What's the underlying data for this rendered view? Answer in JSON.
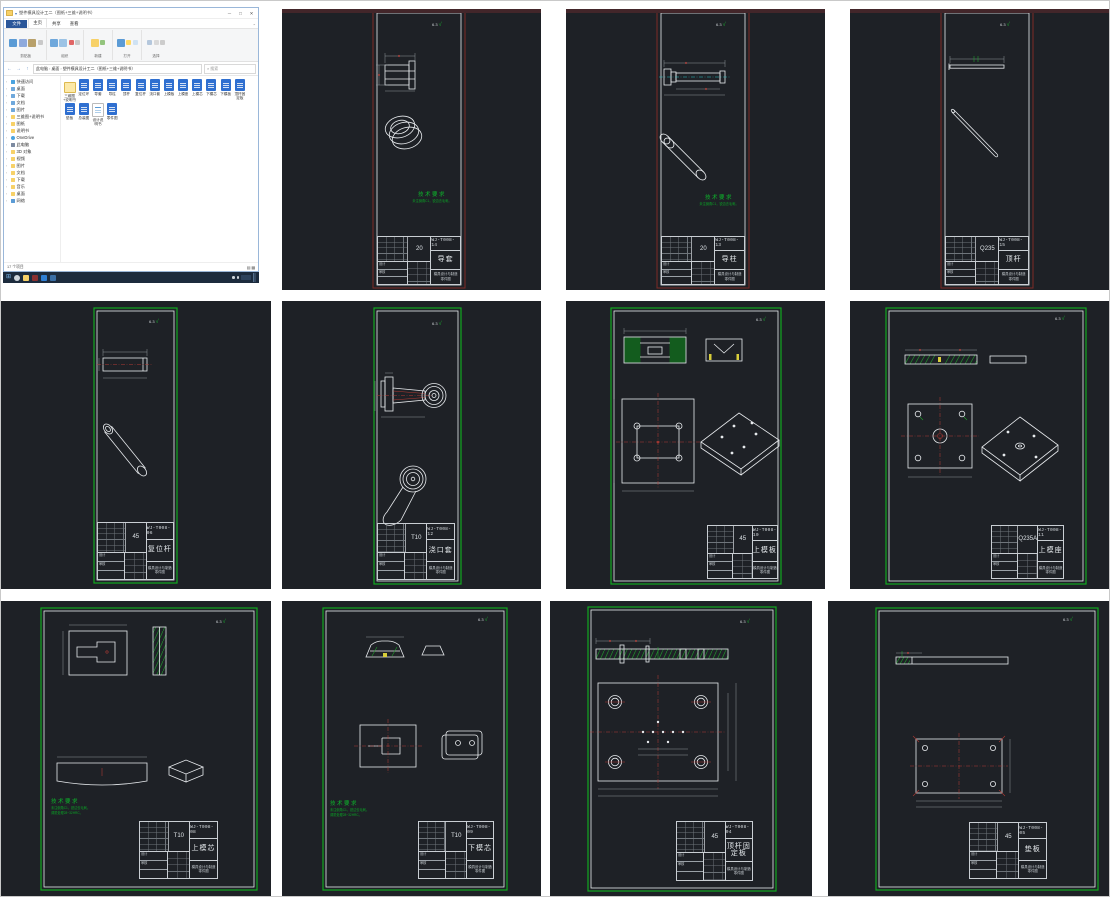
{
  "explorer": {
    "title": "塑件模具设计工二（图纸+三维+说明书）",
    "tabs": [
      "文件",
      "主页",
      "共享",
      "查看"
    ],
    "ribbon_groups": [
      "剪贴板",
      "组织",
      "新建",
      "打开",
      "选择"
    ],
    "address": [
      "此电脑",
      "桌面",
      "塑件模具设计工二（图纸+三维+说明书）"
    ],
    "search_placeholder": "搜索",
    "nav": [
      {
        "label": "快速访问",
        "icon": "star"
      },
      {
        "label": "桌面",
        "icon": "desk"
      },
      {
        "label": "下载",
        "icon": "down"
      },
      {
        "label": "文档",
        "icon": "doc"
      },
      {
        "label": "图片",
        "icon": "pic"
      },
      {
        "label": "三维图+说明书",
        "icon": "folder"
      },
      {
        "label": "图纸",
        "icon": "folder"
      },
      {
        "label": "说明书",
        "icon": "folder"
      },
      {
        "label": "OneDrive",
        "icon": "cloud"
      },
      {
        "label": "此电脑",
        "icon": "pc"
      },
      {
        "label": "3D 对象",
        "icon": "folder"
      },
      {
        "label": "视频",
        "icon": "folder"
      },
      {
        "label": "图片",
        "icon": "folder"
      },
      {
        "label": "文档",
        "icon": "folder"
      },
      {
        "label": "下载",
        "icon": "folder"
      },
      {
        "label": "音乐",
        "icon": "folder"
      },
      {
        "label": "桌面",
        "icon": "folder"
      },
      {
        "label": "网络",
        "icon": "net"
      }
    ],
    "files": [
      {
        "name": "三维图+说明书",
        "type": "folder"
      },
      {
        "name": "定位环",
        "type": "dwg"
      },
      {
        "name": "导套",
        "type": "dwg"
      },
      {
        "name": "导柱",
        "type": "dwg"
      },
      {
        "name": "顶杆",
        "type": "dwg"
      },
      {
        "name": "复位杆",
        "type": "dwg"
      },
      {
        "name": "浇口套",
        "type": "dwg"
      },
      {
        "name": "上模板",
        "type": "dwg"
      },
      {
        "name": "上模座",
        "type": "dwg"
      },
      {
        "name": "上模芯",
        "type": "dwg"
      },
      {
        "name": "下模芯",
        "type": "dwg"
      },
      {
        "name": "下模板",
        "type": "dwg"
      },
      {
        "name": "顶杆固定板",
        "type": "dwg"
      },
      {
        "name": "垫板",
        "type": "dwg"
      },
      {
        "name": "总装图",
        "type": "dwg"
      },
      {
        "name": "设计说明书",
        "type": "doc"
      },
      {
        "name": "零件图",
        "type": "dwg"
      }
    ],
    "status": "17 个项目"
  },
  "cad_common": {
    "roughness": "6.3",
    "tech_req_title": "技术要求",
    "tech_req_lines": [
      "未注倒角C1，锐边去毛刺。",
      "调质处理28~32HRC。"
    ],
    "org_line1": "模具设计与制造",
    "org_line2": "零件图",
    "tb_row1": "设计",
    "tb_row2": "审核"
  },
  "cad_tiles": [
    {
      "name": "导套",
      "material": "20",
      "number": "WJ-T008-14"
    },
    {
      "name": "导柱",
      "material": "20",
      "number": "WJ-T008-13"
    },
    {
      "name": "顶杆",
      "material": "Q235",
      "number": "WJ-T008-15"
    },
    {
      "name": "复位杆",
      "material": "45",
      "number": "WJ-T008-06"
    },
    {
      "name": "浇口套",
      "material": "T10",
      "number": "WJ-T008-12"
    },
    {
      "name": "上模板",
      "material": "45",
      "number": "WJ-T008-10"
    },
    {
      "name": "上模座",
      "material": "Q235A",
      "number": "WJ-T008-11"
    },
    {
      "name": "上模芯",
      "material": "T10",
      "number": "WJ-T008-08"
    },
    {
      "name": "下模芯",
      "material": "T10",
      "number": "WJ-T008-09"
    },
    {
      "name": "顶杆固定板",
      "material": "45",
      "number": "WJ-T008-04"
    },
    {
      "name": "垫板",
      "material": "45",
      "number": "WJ-T008-05"
    }
  ]
}
